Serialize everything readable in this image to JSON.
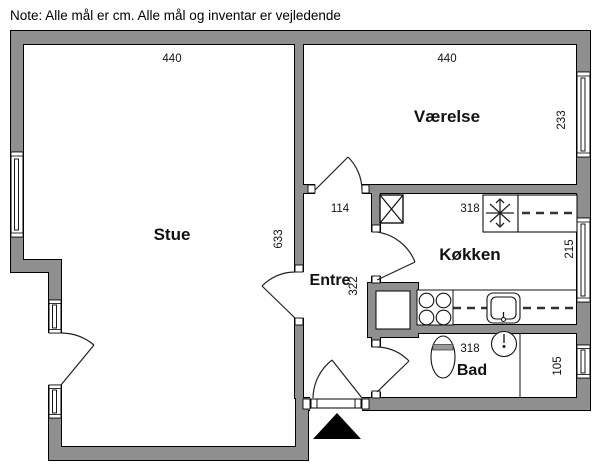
{
  "note": "Note: Alle mål er cm. Alle mål og inventar er vejledende",
  "rooms": {
    "stue": {
      "label": "Stue",
      "width_cm": "440",
      "depth_cm": "633"
    },
    "vaerelse": {
      "label": "Værelse",
      "width_cm": "440",
      "depth_cm": "233"
    },
    "entre": {
      "label": "Entre",
      "width_cm": "114",
      "depth_cm": "322"
    },
    "koekken": {
      "label": "Køkken",
      "width_cm": "318",
      "depth_cm": "215"
    },
    "bad": {
      "label": "Bad",
      "width_cm": "318",
      "depth_cm": "105"
    }
  },
  "colors": {
    "wall": "#8f8f8f",
    "outline": "#000000",
    "background": "#ffffff"
  },
  "icons": {
    "vent_shaft": "vent-shaft-icon",
    "freezer_star": "freezer-star-icon",
    "overhead_cabinets": "overhead-cabinet-dash-line",
    "stove": "stove-burners-icon",
    "kitchen_sink": "kitchen-sink-icon",
    "toilet": "toilet-icon",
    "washbasin": "washbasin-icon",
    "entrance_marker": "entrance-arrow-icon",
    "window": "window-symbol",
    "door": "door-swing-symbol"
  }
}
